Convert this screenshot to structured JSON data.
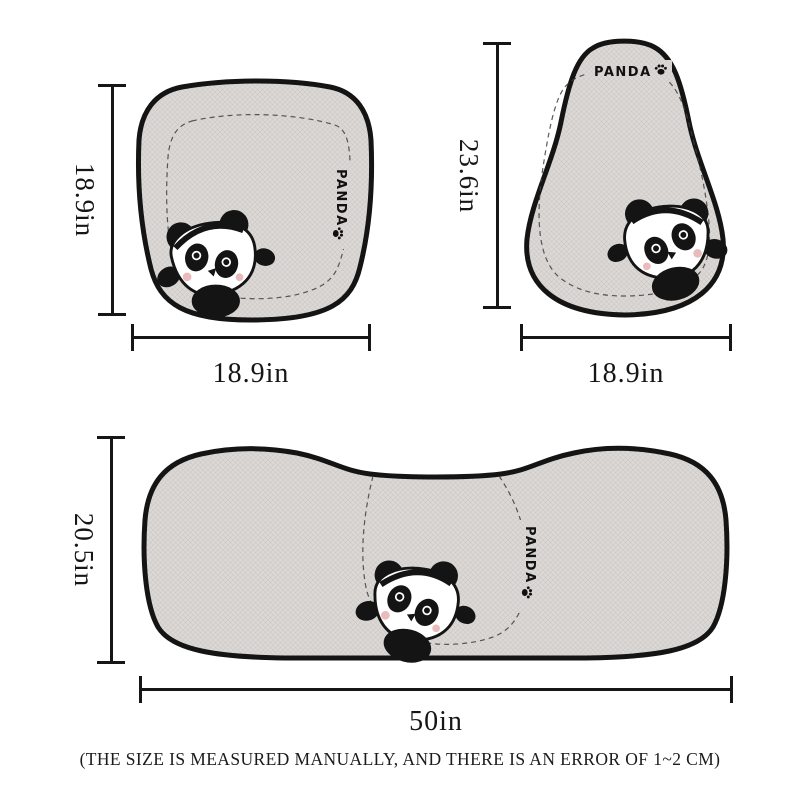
{
  "brand": {
    "name": "PANDA"
  },
  "cushions": {
    "front": {
      "name": "front seat cushion",
      "height": "18.9in",
      "width": "18.9in"
    },
    "backrest": {
      "name": "seat backrest cover",
      "height": "23.6in",
      "width": "18.9in"
    },
    "bench": {
      "name": "rear bench cushion",
      "height": "20.5in",
      "width": "50in"
    }
  },
  "note": "(THE SIZE IS MEASURED MANUALLY, AND THERE IS AN ERROR OF 1~2 CM)",
  "icons": {
    "paw": "paw-print-icon",
    "panda": "panda-face-embroidery"
  },
  "colors": {
    "background": "#ffffff",
    "fabric": "#dbd8d5",
    "fabric_weave": "#ccc9c6",
    "outline": "#141414",
    "stitch": "#3e3e3e",
    "dimension_lines": "#161616",
    "cheek_pink": "#eabbbb"
  }
}
